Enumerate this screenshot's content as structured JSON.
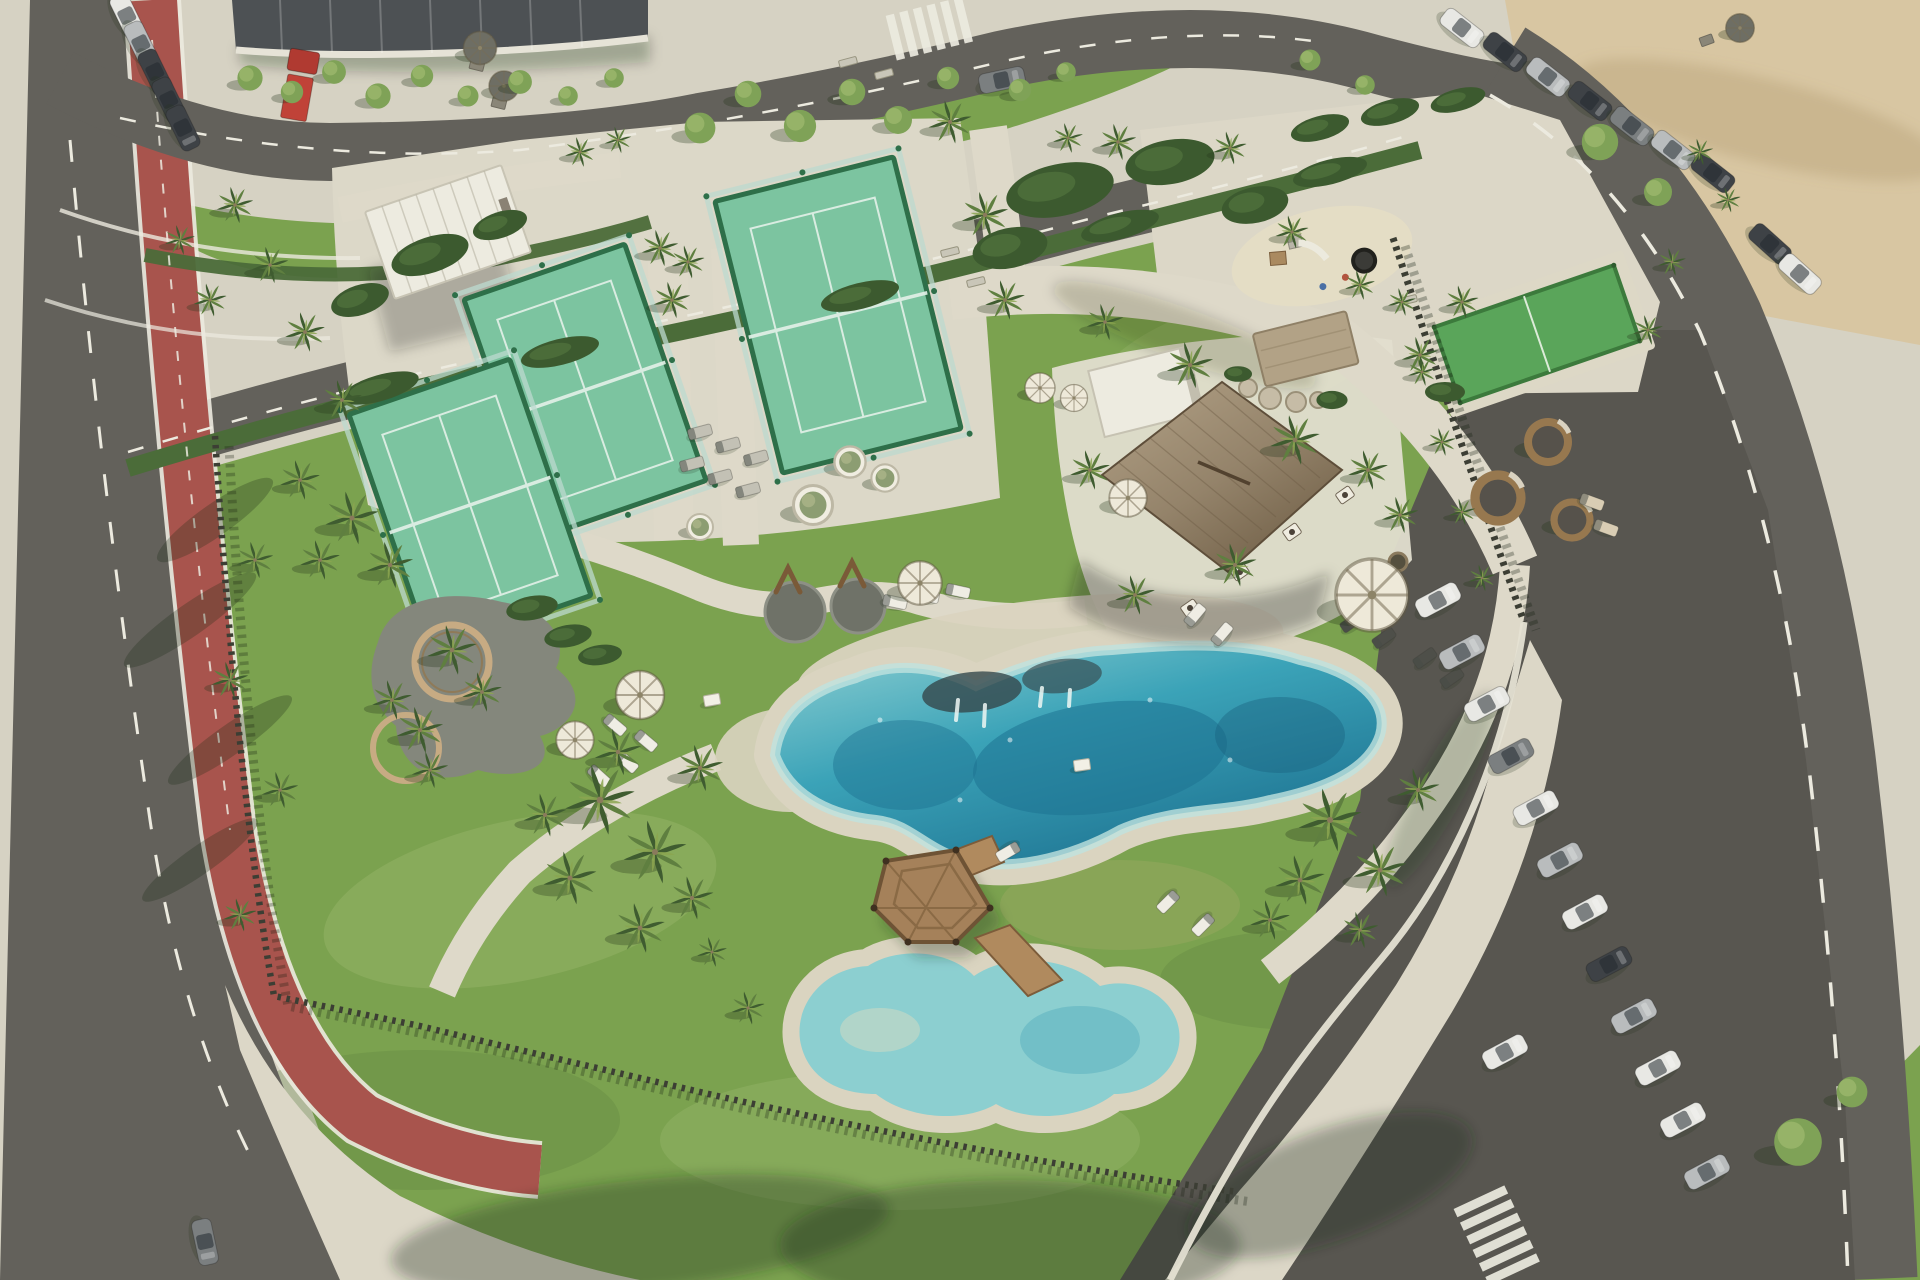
{
  "meta": {
    "label": "Aerial rendering of a coastal resort amenity park with lagoon pool, padel courts, thatched pavilion, playground, roads and parking lots"
  },
  "colors": {
    "pavement": "#d6d2c3",
    "pavementBright": "#e2decf",
    "apron": "#dcd7c7",
    "concourse": "#dcd8c8",
    "sand": "#d8c6a2",
    "asphalt": "#63615b",
    "asphaltDark": "#585650",
    "bikePath": "#a8544d",
    "roadLine": "#eceadf",
    "grass": "#7ba24f",
    "grassLight": "#95b468",
    "grassDark": "#5e8140",
    "grassDry": "#a4ad68",
    "hedge": "#4b6c39",
    "hedgeDark": "#3c5a2f",
    "palmDark": "#3f5c30",
    "palmMid": "#5f7f40",
    "palmLight": "#8ba550",
    "trunk": "#8a7a5c",
    "treeLight": "#7fa257",
    "treeLighter": "#9cb86d",
    "courtTurf": "#7cc4a0",
    "courtFrame": "#2e6f49",
    "courtGlass": "#bcd9cf",
    "bocceTurf": "#5aa55a",
    "poolDeep": "#1d7291",
    "poolMid": "#3ba3b8",
    "poolShallow": "#9fd6d6",
    "poolFoam": "#eef7f4",
    "kidsWater": "#8ccfd0",
    "rim": "#dad4c0",
    "thatch": "#9b8a6f",
    "thatchDark": "#73614a",
    "thatchLight": "#b3a287",
    "white": "#edebe0",
    "whiteShade": "#c2beae",
    "wood": "#a5815a",
    "woodDark": "#6e5335",
    "stone": "#b2a286",
    "boulder": "#c6bca6",
    "fence": "#3c3e34",
    "wall": "#e5e1d3",
    "umbrella": "#eee9d9",
    "umbrellaDark": "#6e6e64",
    "gravel": "#84877c",
    "ringWood": "#c7ab83",
    "carWhite": "#e8e8e4",
    "carSilver": "#b9bcbd",
    "carGrey": "#7b7f80",
    "carDark": "#3e4246",
    "truckRed": "#b03a31",
    "podWood": "#97784f",
    "podSeat": "#56524b",
    "shadow": "rgba(36,52,28,0.30)"
  },
  "scene": {
    "palms": [
      [
        235,
        205,
        0.55
      ],
      [
        270,
        265,
        0.55
      ],
      [
        305,
        332,
        0.6
      ],
      [
        342,
        400,
        0.6
      ],
      [
        210,
        300,
        0.5
      ],
      [
        180,
        240,
        0.45
      ],
      [
        255,
        560,
        0.55
      ],
      [
        230,
        680,
        0.55
      ],
      [
        280,
        790,
        0.55
      ],
      [
        240,
        915,
        0.5
      ],
      [
        300,
        480,
        0.6
      ],
      [
        352,
        518,
        0.8
      ],
      [
        390,
        565,
        0.7
      ],
      [
        320,
        560,
        0.6
      ],
      [
        452,
        650,
        0.75
      ],
      [
        482,
        692,
        0.6
      ],
      [
        420,
        730,
        0.7
      ],
      [
        392,
        700,
        0.6
      ],
      [
        430,
        770,
        0.55
      ],
      [
        660,
        248,
        0.55
      ],
      [
        688,
        262,
        0.5
      ],
      [
        672,
        300,
        0.55
      ],
      [
        580,
        152,
        0.45
      ],
      [
        618,
        140,
        0.4
      ],
      [
        950,
        122,
        0.65
      ],
      [
        985,
        215,
        0.7
      ],
      [
        1005,
        300,
        0.6
      ],
      [
        1118,
        142,
        0.55
      ],
      [
        1230,
        148,
        0.5
      ],
      [
        1292,
        232,
        0.5
      ],
      [
        1360,
        285,
        0.45
      ],
      [
        1105,
        322,
        0.55
      ],
      [
        1068,
        138,
        0.45
      ],
      [
        1190,
        365,
        0.7
      ],
      [
        1295,
        440,
        0.75
      ],
      [
        1235,
        565,
        0.65
      ],
      [
        1135,
        595,
        0.6
      ],
      [
        1420,
        355,
        0.55
      ],
      [
        1462,
        302,
        0.5
      ],
      [
        1368,
        470,
        0.6
      ],
      [
        1400,
        515,
        0.55
      ],
      [
        1090,
        470,
        0.6
      ],
      [
        600,
        800,
        1.05
      ],
      [
        655,
        852,
        0.95
      ],
      [
        570,
        878,
        0.8
      ],
      [
        640,
        928,
        0.75
      ],
      [
        700,
        768,
        0.7
      ],
      [
        545,
        815,
        0.65
      ],
      [
        692,
        898,
        0.65
      ],
      [
        618,
        752,
        0.7
      ],
      [
        1330,
        820,
        0.95
      ],
      [
        1380,
        870,
        0.8
      ],
      [
        1300,
        880,
        0.75
      ],
      [
        1418,
        790,
        0.65
      ],
      [
        1270,
        920,
        0.6
      ],
      [
        1360,
        930,
        0.55
      ],
      [
        748,
        1008,
        0.5
      ],
      [
        712,
        952,
        0.45
      ],
      [
        1402,
        302,
        0.42
      ],
      [
        1422,
        372,
        0.42
      ],
      [
        1442,
        442,
        0.42
      ],
      [
        1462,
        512,
        0.4
      ],
      [
        1482,
        578,
        0.4
      ],
      [
        1672,
        262,
        0.42
      ],
      [
        1648,
        330,
        0.45
      ],
      [
        1700,
        152,
        0.4
      ],
      [
        1728,
        200,
        0.38
      ]
    ],
    "ltrees": [
      [
        250,
        78,
        0.9
      ],
      [
        292,
        92,
        0.8
      ],
      [
        334,
        72,
        0.85
      ],
      [
        378,
        96,
        0.9
      ],
      [
        422,
        76,
        0.8
      ],
      [
        468,
        96,
        0.75
      ],
      [
        520,
        82,
        0.85
      ],
      [
        568,
        96,
        0.7
      ],
      [
        614,
        78,
        0.7
      ],
      [
        700,
        128,
        1.1
      ],
      [
        748,
        94,
        0.95
      ],
      [
        800,
        126,
        1.15
      ],
      [
        852,
        92,
        0.95
      ],
      [
        898,
        120,
        1.0
      ],
      [
        948,
        78,
        0.8
      ],
      [
        1020,
        90,
        0.8
      ],
      [
        1066,
        72,
        0.7
      ],
      [
        1310,
        60,
        0.75
      ],
      [
        1365,
        85,
        0.7
      ],
      [
        1600,
        142,
        1.3
      ],
      [
        1658,
        192,
        1.0
      ],
      [
        1798,
        1142,
        1.7
      ],
      [
        1852,
        1092,
        1.1
      ]
    ],
    "bushes": [
      [
        380,
        388,
        -16,
        1.54,
        1.0
      ],
      [
        560,
        352,
        -14,
        1.54,
        1.0
      ],
      [
        860,
        296,
        -14,
        1.54,
        1.0
      ],
      [
        1120,
        226,
        -15,
        1.54,
        1.0
      ],
      [
        1330,
        172,
        -14,
        1.46,
        0.95
      ],
      [
        1060,
        190,
        -12,
        2.1,
        2.0
      ],
      [
        1170,
        162,
        -10,
        1.73,
        1.7
      ],
      [
        1010,
        248,
        -12,
        1.46,
        1.54
      ],
      [
        1255,
        205,
        -12,
        1.3,
        1.38
      ],
      [
        430,
        255,
        -18,
        1.54,
        1.38
      ],
      [
        360,
        300,
        -18,
        1.15,
        1.15
      ],
      [
        500,
        225,
        -18,
        1.08,
        1.0
      ],
      [
        532,
        608,
        -10,
        1.0,
        0.92
      ],
      [
        568,
        636,
        -10,
        0.92,
        0.85
      ],
      [
        600,
        655,
        -8,
        0.85,
        0.77
      ],
      [
        1238,
        374,
        0,
        0.54,
        0.6
      ],
      [
        1332,
        400,
        0,
        0.6,
        0.7
      ],
      [
        1445,
        392,
        0,
        0.77,
        0.77
      ],
      [
        1320,
        128,
        -15,
        1.15,
        0.92
      ],
      [
        1390,
        112,
        -15,
        1.15,
        0.92
      ],
      [
        1458,
        100,
        -15,
        1.08,
        0.85
      ]
    ],
    "umbrellas": [
      [
        920,
        583,
        1.45
      ],
      [
        1128,
        498,
        1.25
      ],
      [
        640,
        695,
        1.6
      ],
      [
        575,
        740,
        1.25
      ],
      [
        1372,
        595,
        2.4
      ],
      [
        1040,
        388,
        1.0
      ],
      [
        1074,
        398,
        0.9
      ],
      [
        480,
        48,
        1.1,
        "umbrellaDark"
      ],
      [
        504,
        86,
        1.0,
        "umbrellaDark"
      ],
      [
        1740,
        28,
        0.95,
        "umbrellaDark"
      ]
    ],
    "loungers": [
      [
        895,
        602,
        12
      ],
      [
        927,
        596,
        12
      ],
      [
        958,
        591,
        12
      ],
      [
        1195,
        615,
        -50
      ],
      [
        1222,
        634,
        -50
      ],
      [
        615,
        725,
        40
      ],
      [
        646,
        741,
        40
      ],
      [
        627,
        762,
        42
      ],
      [
        599,
        776,
        42
      ],
      [
        1168,
        902,
        135
      ],
      [
        1203,
        925,
        135
      ],
      [
        1008,
        852,
        150
      ],
      [
        700,
        432,
        -15,
        "#c3c1b5"
      ],
      [
        728,
        445,
        -15,
        "#c3c1b5"
      ],
      [
        756,
        458,
        -15,
        "#c3c1b5"
      ],
      [
        692,
        464,
        -15,
        "#c3c1b5"
      ],
      [
        720,
        477,
        -15,
        "#c3c1b5"
      ],
      [
        748,
        490,
        -15,
        "#c3c1b5"
      ],
      [
        1592,
        502,
        20,
        "#d9cdb4"
      ],
      [
        1606,
        528,
        20,
        "#d9cdb4"
      ],
      [
        1352,
        622,
        -35,
        "#4e4f49"
      ],
      [
        1384,
        638,
        -35,
        "#4e4f49"
      ],
      [
        1425,
        658,
        -35,
        "#4e4f49"
      ],
      [
        1452,
        678,
        -35,
        "#4e4f49"
      ]
    ],
    "planters": [
      [
        813,
        505,
        1.5
      ],
      [
        850,
        462,
        1.2
      ],
      [
        885,
        478,
        1.05
      ],
      [
        700,
        527,
        1.0
      ]
    ],
    "pods": [
      [
        1498,
        498,
        1.15
      ],
      [
        1548,
        442,
        1.0
      ],
      [
        1572,
        520,
        0.9
      ]
    ],
    "benches": [
      [
        950,
        252,
        -14
      ],
      [
        976,
        282,
        -14
      ],
      [
        1408,
        300,
        -14
      ],
      [
        848,
        62,
        -15
      ],
      [
        884,
        74,
        -15
      ]
    ],
    "boxes": [
      [
        712,
        700,
        -10
      ],
      [
        1082,
        765,
        -8
      ]
    ],
    "cars": [
      [
        127,
        16,
        64,
        "carWhite"
      ],
      [
        141,
        44,
        64,
        "carSilver"
      ],
      [
        155,
        72,
        64,
        "carDark"
      ],
      [
        169,
        100,
        64,
        "carDark"
      ],
      [
        183,
        128,
        64,
        "carDark"
      ],
      [
        1002,
        80,
        -12,
        "carGrey"
      ],
      [
        1462,
        28,
        38,
        "carWhite"
      ],
      [
        1505,
        52,
        38,
        "carDark"
      ],
      [
        1548,
        77,
        38,
        "carSilver"
      ],
      [
        1590,
        101,
        38,
        "carDark"
      ],
      [
        1632,
        126,
        38,
        "carGrey"
      ],
      [
        1673,
        150,
        38,
        "carSilver"
      ],
      [
        1713,
        173,
        38,
        "carDark"
      ],
      [
        1770,
        244,
        42,
        "carDark"
      ],
      [
        1800,
        274,
        42,
        "carWhite"
      ],
      [
        1438,
        600,
        -28,
        "carWhite"
      ],
      [
        1462,
        652,
        -28,
        "carSilver"
      ],
      [
        1487,
        704,
        -28,
        "carWhite"
      ],
      [
        1511,
        756,
        -28,
        "carGrey"
      ],
      [
        1536,
        808,
        -28,
        "carWhite"
      ],
      [
        1560,
        860,
        -28,
        "carSilver"
      ],
      [
        1585,
        912,
        -28,
        "carWhite"
      ],
      [
        1609,
        964,
        -28,
        "carDark"
      ],
      [
        1634,
        1016,
        -28,
        "carSilver"
      ],
      [
        1658,
        1068,
        -28,
        "carWhite"
      ],
      [
        1683,
        1120,
        -28,
        "carWhite"
      ],
      [
        1707,
        1172,
        -28,
        "carSilver"
      ],
      [
        1505,
        1052,
        -28,
        "carWhite"
      ],
      [
        205,
        1242,
        78,
        "carGrey"
      ]
    ]
  }
}
